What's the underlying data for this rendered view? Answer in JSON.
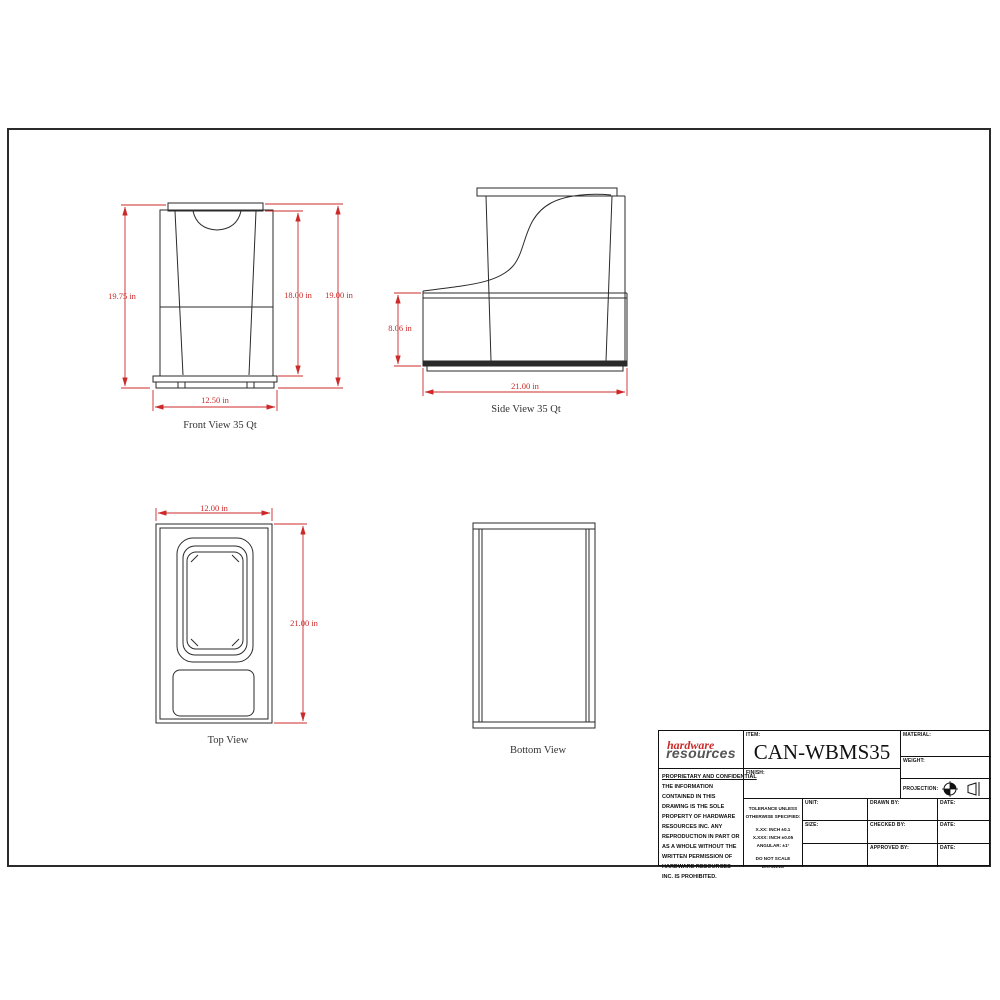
{
  "sheet": {
    "bg": "#ffffff",
    "line_color": "#2a2a2a",
    "dim_color": "#cc2a2a"
  },
  "views": {
    "front": {
      "label": "Front View 35 Qt",
      "dim_left": "19.75 in",
      "dim_mid": "18.00 in",
      "dim_right": "19.00 in",
      "dim_bottom": "12.50 in"
    },
    "side": {
      "label": "Side View 35 Qt",
      "dim_left": "8.06 in",
      "dim_bottom": "21.00 in"
    },
    "top": {
      "label": "Top View",
      "dim_top": "12.00 in",
      "dim_right": "21.00 in"
    },
    "bottom": {
      "label": "Bottom View"
    }
  },
  "title_block": {
    "logo_line1": "hardware",
    "logo_line2": "resources",
    "item_label": "ITEM:",
    "item_value": "CAN-WBMS35",
    "finish_label": "FINISH:",
    "material_label": "MATERIAL:",
    "weight_label": "WEIGHT:",
    "projection_label": "PROJECTION:",
    "proprietary_title": "PROPRIETARY AND CONFIDENTIAL",
    "proprietary_body": "THE INFORMATION CONTAINED IN THIS DRAWING IS THE SOLE PROPERTY OF HARDWARE RESOURCES INC.  ANY REPRODUCTION IN PART OR AS A WHOLE WITHOUT THE WRITTEN PERMISSION OF HARDWARE RESOURCES INC. IS PROHIBITED.",
    "tolerance": {
      "line1": "TOLERANCE UNLESS",
      "line2": "OTHERWISE SPECIFIED:",
      "line3": "X.XX:  INCH ±0.1",
      "line4": "X.XXX: INCH ±0.05",
      "line5": "ANGULAR: ±1°",
      "line6": "DO NOT SCALE DRAWING"
    },
    "unit_label": "UNIT:",
    "size_label": "SIZE:",
    "drawn_by_label": "DRAWN BY:",
    "checked_by_label": "CHECKED BY:",
    "approved_by_label": "APPROVED BY:",
    "date_label": "DATE:"
  }
}
